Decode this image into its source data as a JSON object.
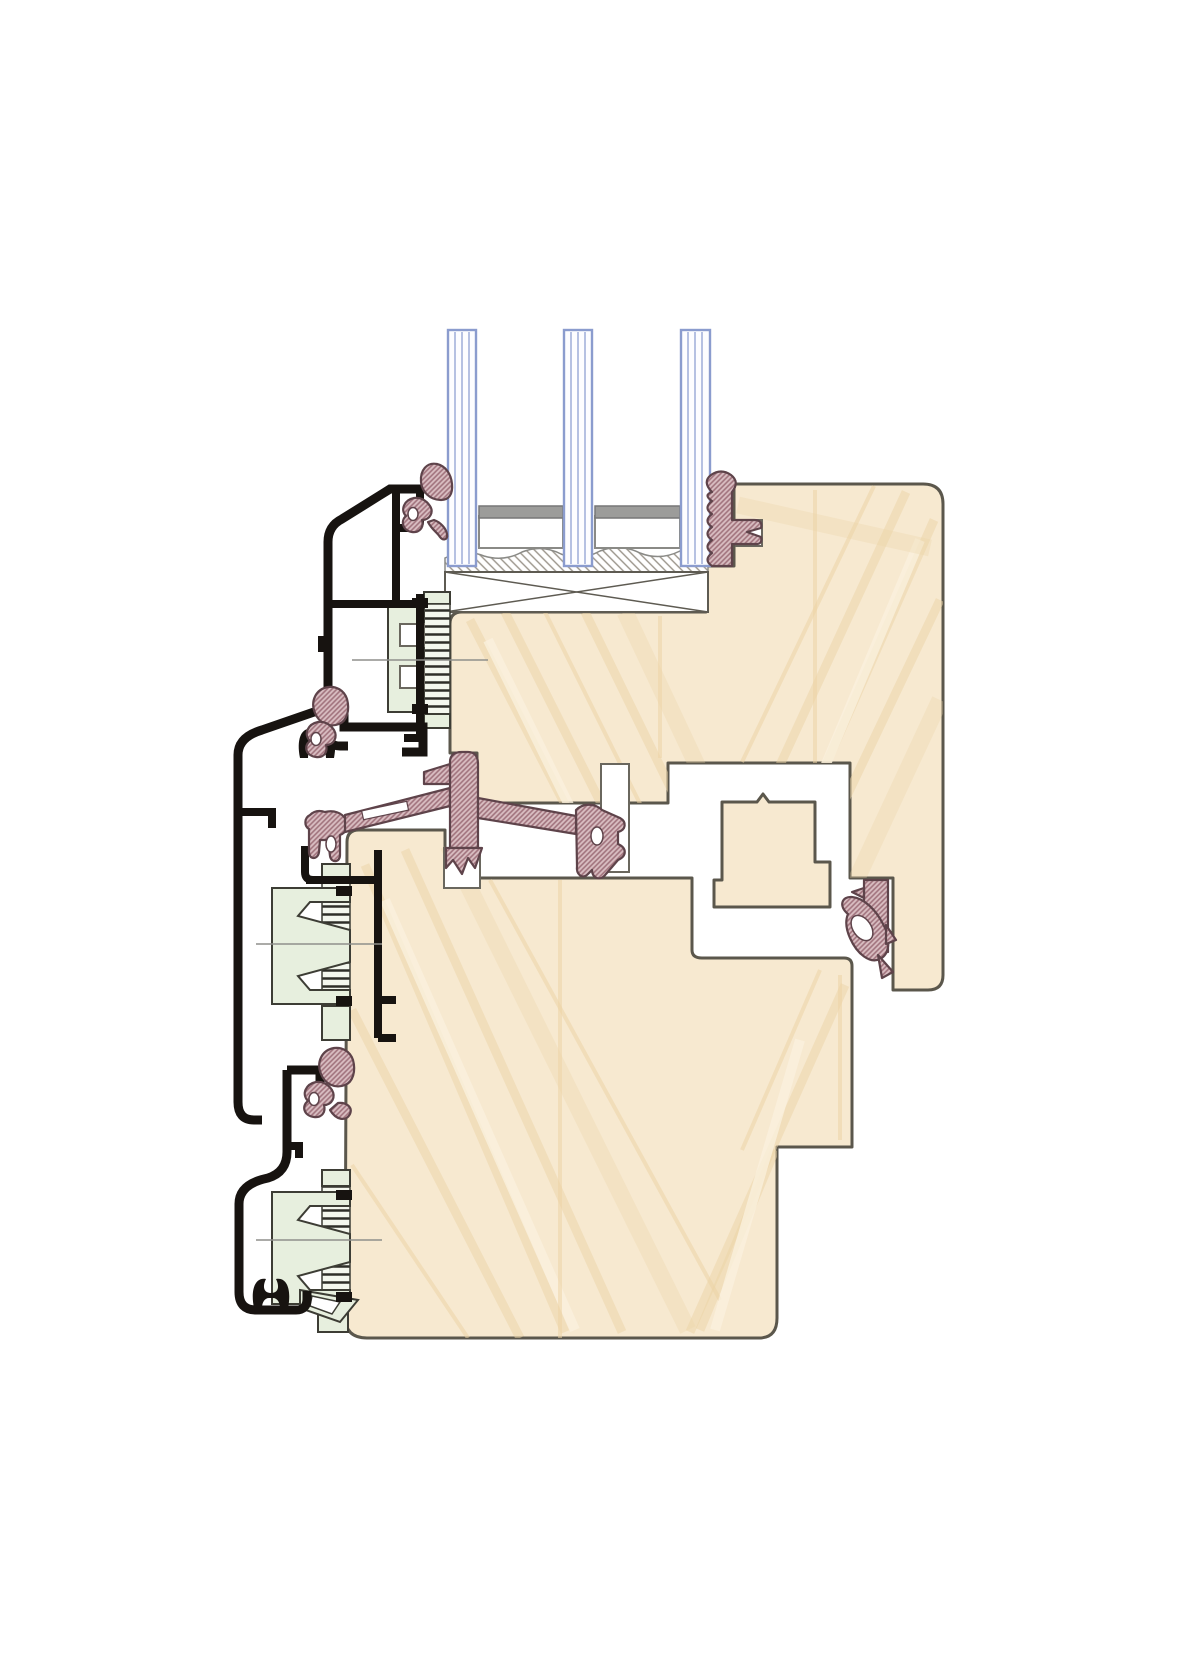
{
  "diagram": {
    "type": "window-profile-cross-section",
    "material_system": "wood-aluminium",
    "glazing": {
      "pane_count": 3,
      "spacer_count": 2,
      "setting_block_count": 1
    },
    "cladding_profile_count": 3,
    "glazing_clip_count": 3,
    "ribbed_connector_count": 3,
    "clip_centerline_count": 3,
    "gaskets": [
      "exterior-top-gasket",
      "glazing-wedge-gasket",
      "mid-frame-gasket",
      "center-seal-gasket",
      "anchor-leaf-gasket",
      "rebate-leaf-gasket",
      "bottom-frame-gasket"
    ],
    "wood_parts": [
      "sash-profile",
      "frame-profile",
      "tongue-block"
    ]
  },
  "colors": {
    "background": "#ffffff",
    "wood_fill": "#f7e9d0",
    "wood_grain": "#ecd3a5",
    "wood_grain_light": "#faf0dd",
    "wood_outline": "#5b574c",
    "aluminium": "#171310",
    "gasket_fill": "#d9bec2",
    "gasket_hatch": "#a0727c",
    "gasket_outline": "#5e434a",
    "clip_fill": "#e7efde",
    "clip_outline": "#3d3d35",
    "rib_line": "#2e2e28",
    "glass_edge": "#8b9cce",
    "glass_inner": "#b6c1e2",
    "glass_fill": "#fdfdff",
    "spacer_gray": "#9c9c9a",
    "block_outline": "#5e5b52",
    "slot_outline": "#6a675e",
    "centerline": "#8f8f8b"
  }
}
